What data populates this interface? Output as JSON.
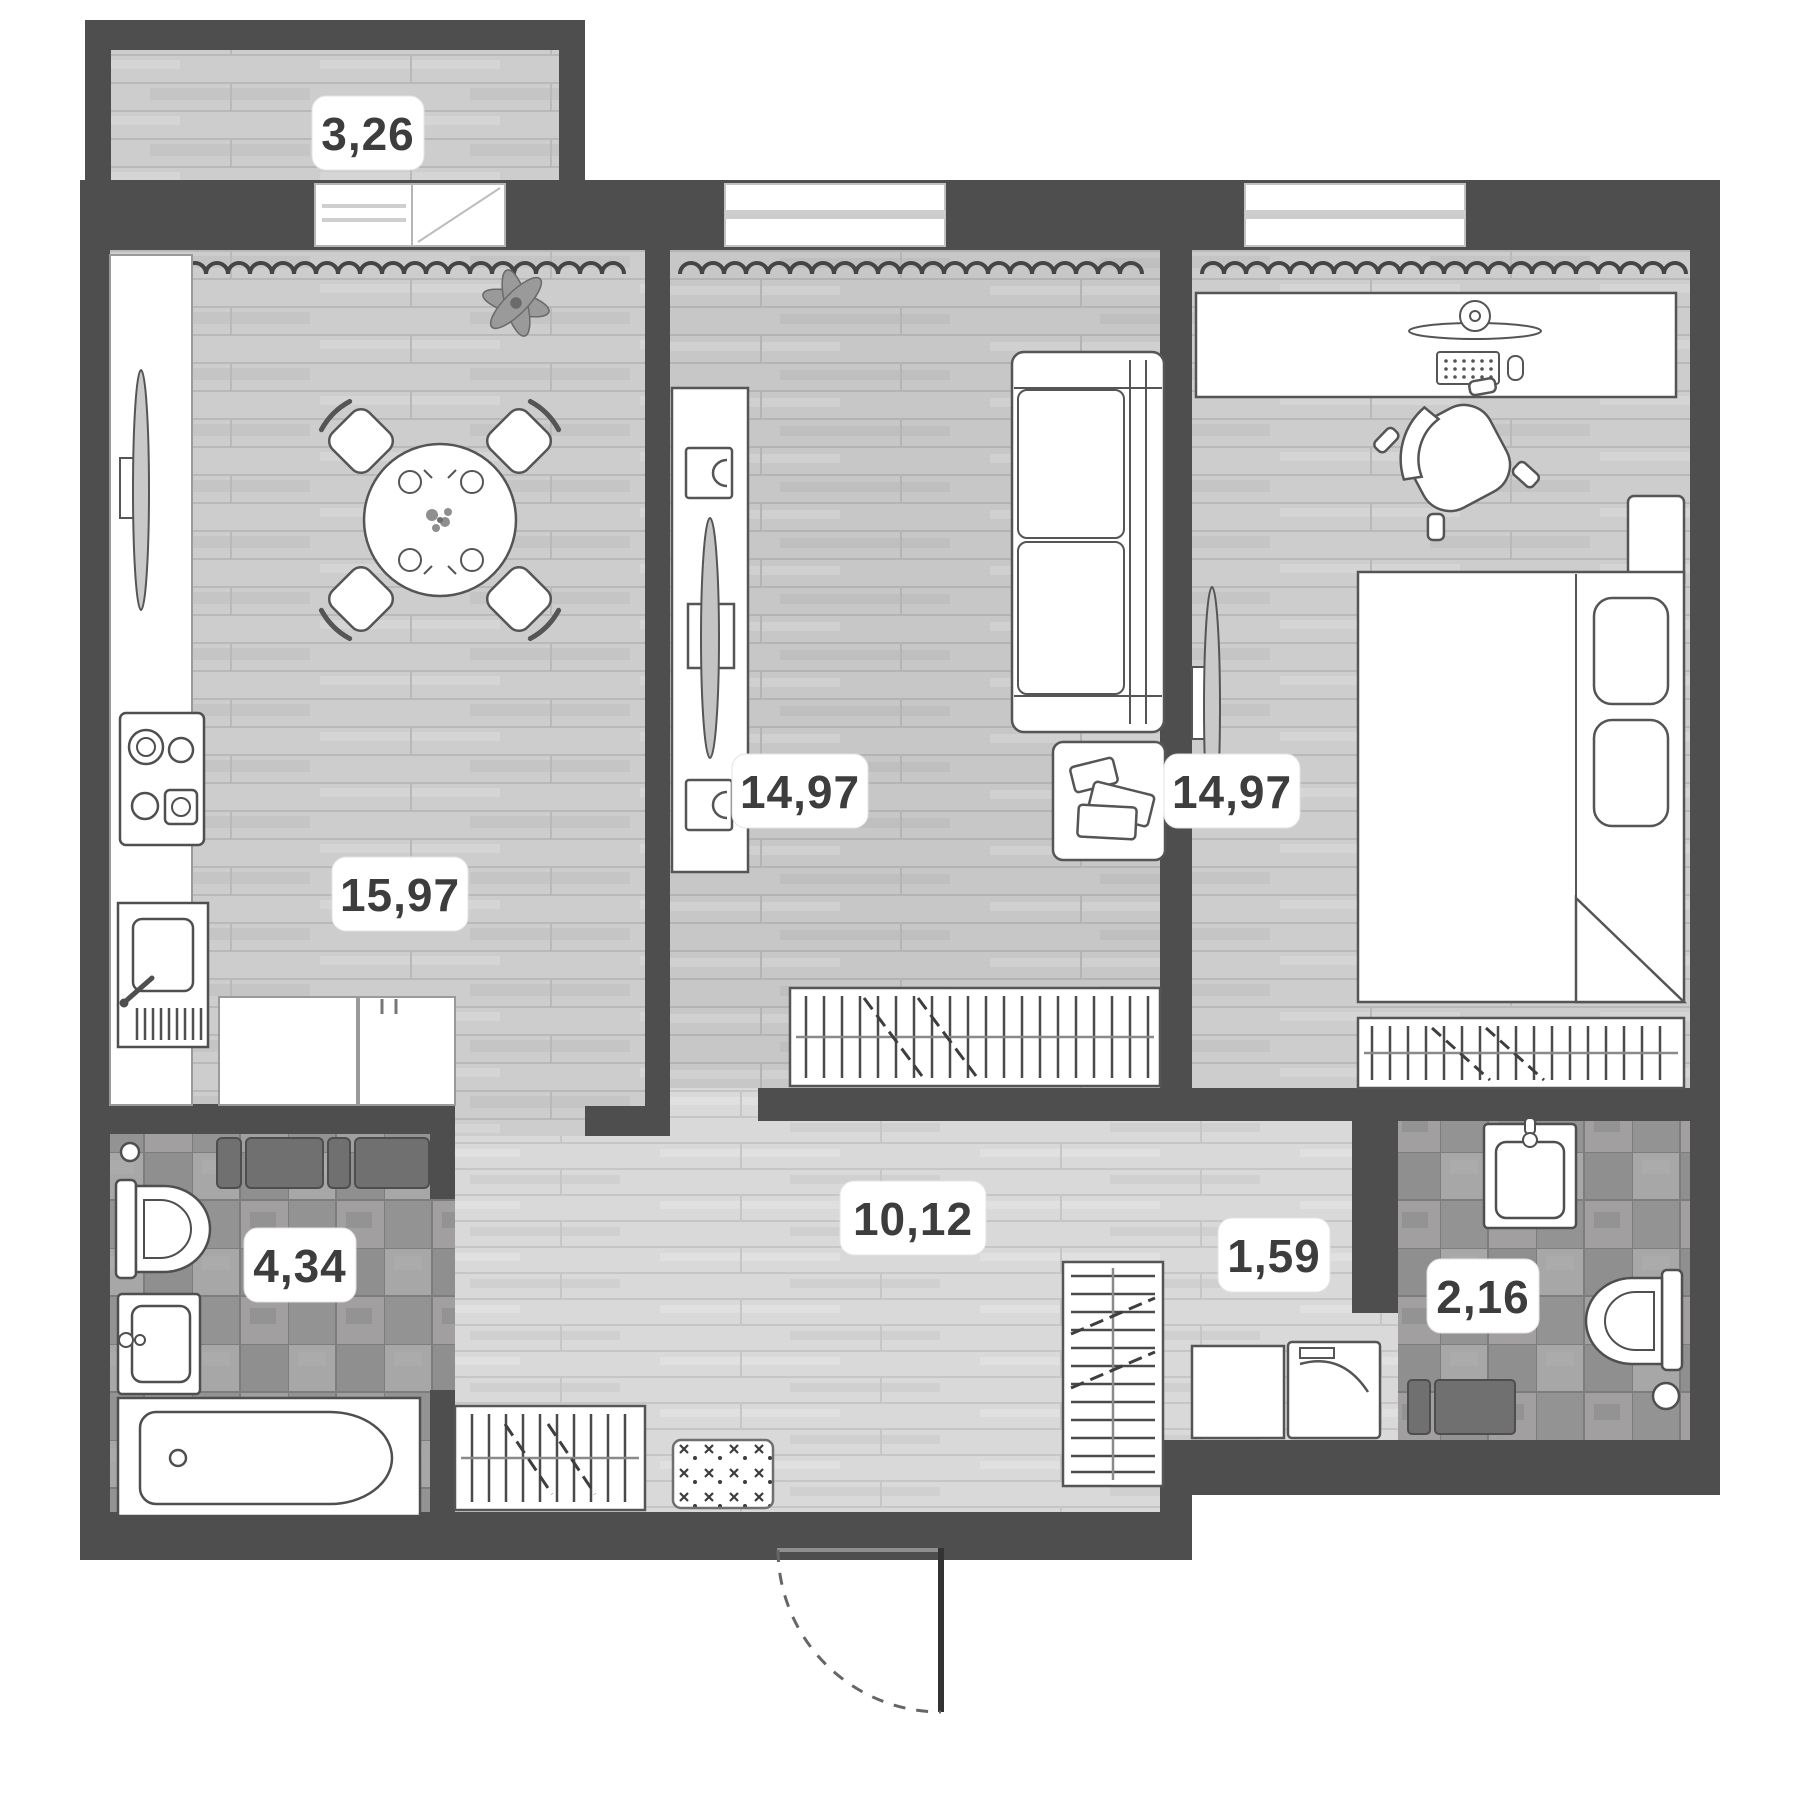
{
  "plan": {
    "title": "apartment-floor-plan",
    "rooms": [
      {
        "name": "balcony",
        "area": "3,26"
      },
      {
        "name": "kitchen-living-room",
        "area": "15,97"
      },
      {
        "name": "living-room",
        "area": "14,97"
      },
      {
        "name": "bedroom",
        "area": "14,97"
      },
      {
        "name": "hallway",
        "area": "10,12"
      },
      {
        "name": "inner-corridor",
        "area": "1,59"
      },
      {
        "name": "bathroom",
        "area": "4,34"
      },
      {
        "name": "toilet-room",
        "area": "2,16"
      }
    ],
    "colors": {
      "wall": "#4e4e4e",
      "label_background": "#ffffff",
      "label_text": "#3d3d3d",
      "wood_floor": "#cdcdcd",
      "wood_floor_hallway": "#d9d9d9",
      "tile_floor": "#9a9a9a",
      "furniture_outline": "#555555",
      "dark_cabinet": "#707070"
    }
  }
}
